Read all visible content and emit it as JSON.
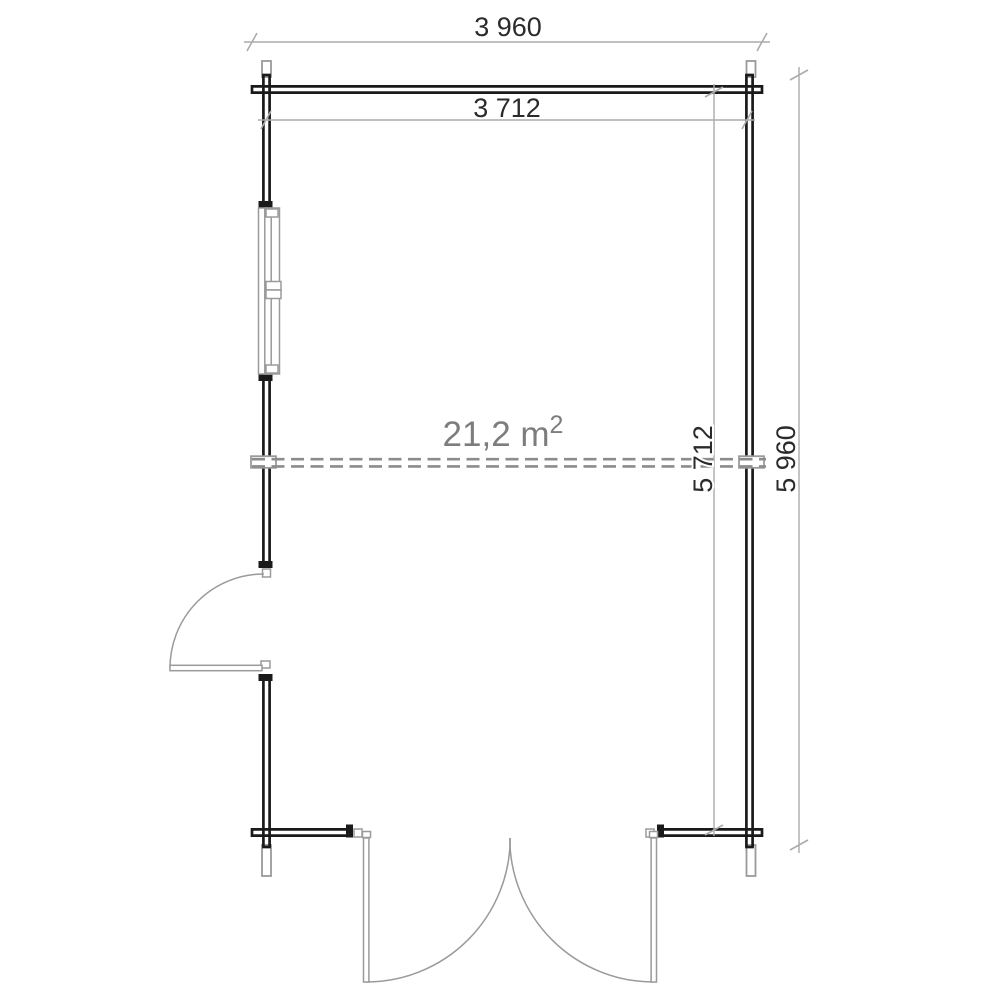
{
  "plan": {
    "area_label": {
      "text": "21,2 m",
      "sup": "2"
    },
    "dimensions": {
      "outer_width": {
        "label": "3 960"
      },
      "inner_width": {
        "label": "3 712"
      },
      "inner_height": {
        "label": "5 712"
      },
      "outer_height": {
        "label": "5 960"
      }
    },
    "features": {
      "window": "window-left-wall",
      "single_door": "door-left-wall",
      "double_door": "double-door-bottom-wall",
      "ridge": "ridge-dashed-line",
      "corners": "log-corner-joints"
    },
    "colors": {
      "wall": "#1a1a1a",
      "fixture": "#9a9a9a",
      "dim_line": "#ababab",
      "dim_text": "#2b2b2b",
      "dash": "#8c8c8c",
      "area_text": "#7d7d7d"
    }
  }
}
